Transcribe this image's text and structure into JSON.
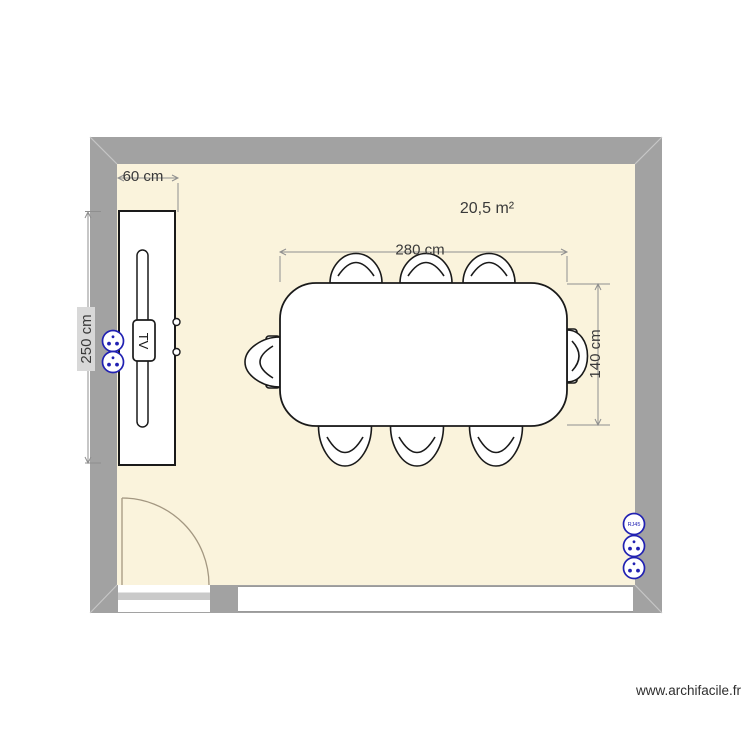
{
  "plan": {
    "area_label": "20,5 m²",
    "dimensions": {
      "cabinet_width": "60 cm",
      "cabinet_length": "250 cm",
      "table_length": "280 cm",
      "table_width": "140 cm"
    },
    "furniture": {
      "tv_label": "TV"
    },
    "outlets": {
      "rj45_label": "RJ45"
    },
    "watermark": "www.archifacile.fr",
    "colors": {
      "wall": "#a2a2a2",
      "miter": "#c6c6c6",
      "floor": "#faf3dc",
      "outline": "#1a1a1a",
      "door": "#a39781",
      "threshold": "#c9c9c9",
      "opening_edge": "#9a9a9a",
      "dimension": "#8f8f8f",
      "dimension_text": "#3a3a3a",
      "dim_label_bg": "#d8d8d8",
      "outlet": "#2121b2",
      "watermark_text": "#2e2e2e"
    }
  }
}
